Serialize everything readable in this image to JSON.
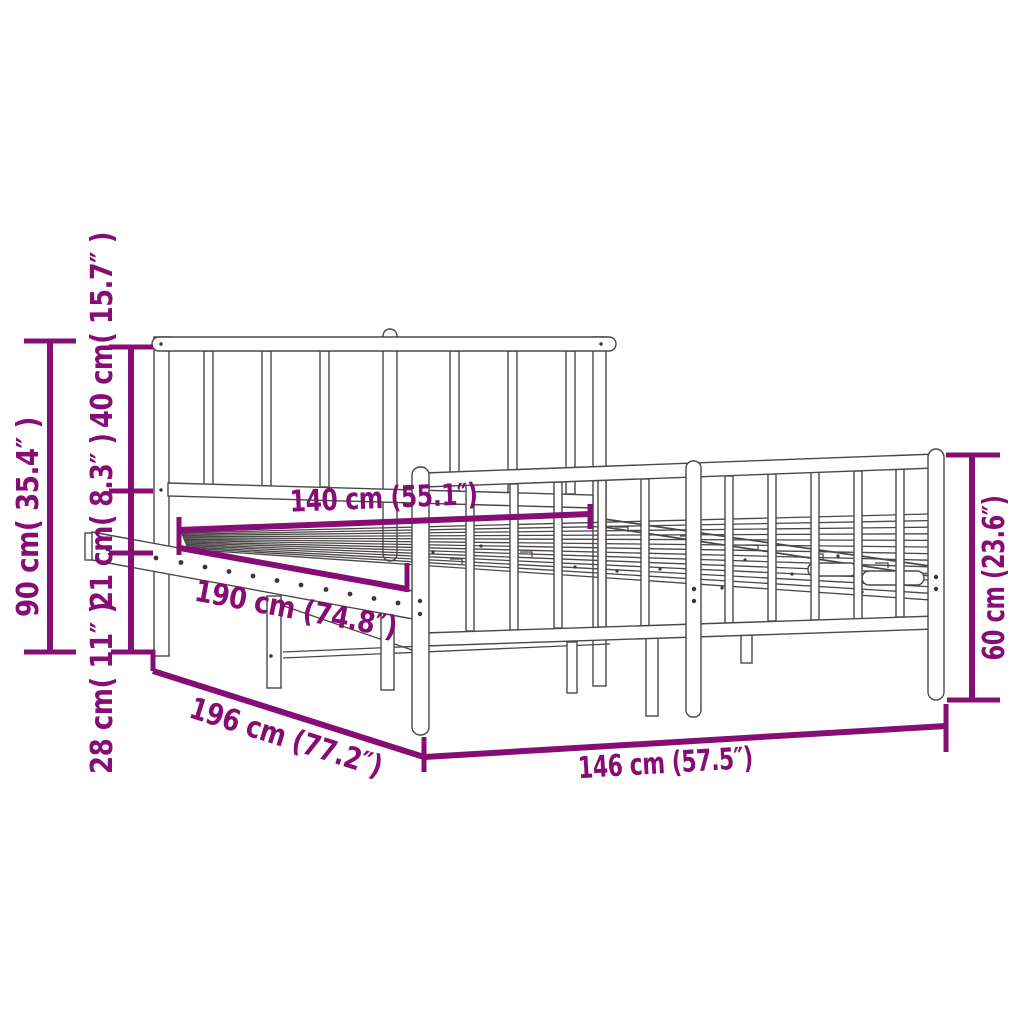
{
  "diagram": {
    "description": "Perspective line drawing of a metal bed frame with headboard and footboard, annotated with product dimensions",
    "colors": {
      "dimension": "#860d74",
      "drawing": "#4b4747",
      "background": "#ffffff"
    },
    "dimensions": {
      "headboard_total_height": "90 cm( 35.4″ )",
      "headboard_above_base": "40 cm( 15.7″ )",
      "frame_side_height": "21 cm( 8.3″ )",
      "under_bed_clearance": "28 cm( 11″ )",
      "mattress_width": "140 cm (55.1″)",
      "mattress_length": "190 cm (74.8″)",
      "frame_outer_length": "196 cm (77.2″)",
      "frame_outer_width": "146 cm (57.5″)",
      "footboard_height": "60 cm (23.6″)"
    }
  }
}
